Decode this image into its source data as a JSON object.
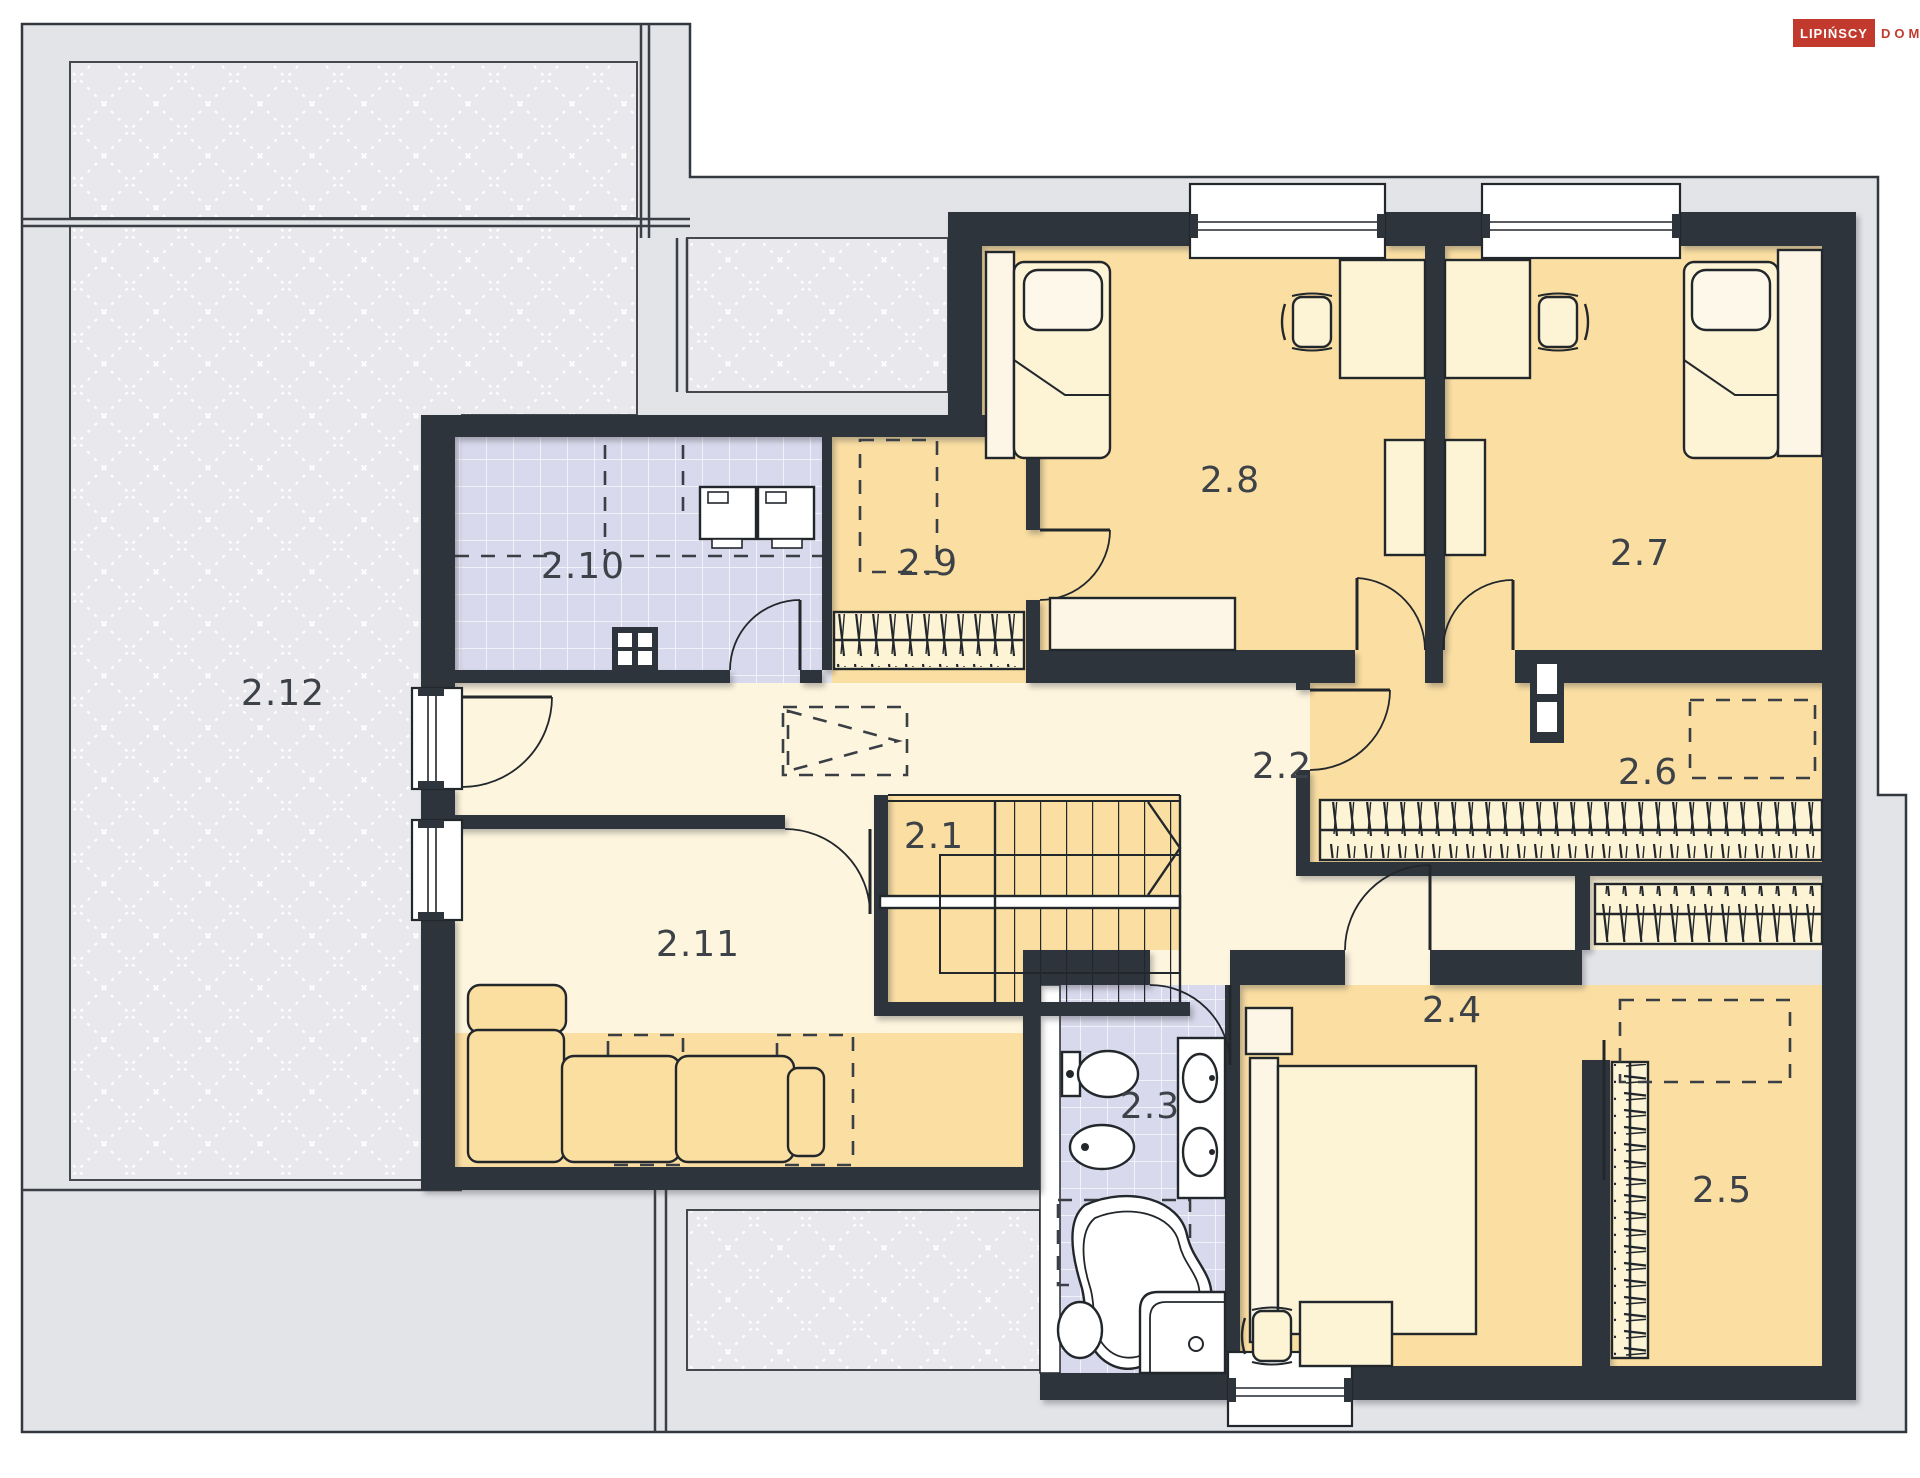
{
  "logo": {
    "primary": "LIPIŃSCY",
    "secondary": "DOMY"
  },
  "rooms": [
    {
      "label": "2.1"
    },
    {
      "label": "2.2"
    },
    {
      "label": "2.3"
    },
    {
      "label": "2.4"
    },
    {
      "label": "2.5"
    },
    {
      "label": "2.6"
    },
    {
      "label": "2.7"
    },
    {
      "label": "2.8"
    },
    {
      "label": "2.9"
    },
    {
      "label": "2.10"
    },
    {
      "label": "2.11"
    },
    {
      "label": "2.12"
    }
  ],
  "colors": {
    "wall": "#2d343c",
    "room_warm": "#fbdfa2",
    "room_light": "#fdf5dd",
    "bathroom_tile": "#d8d9ec",
    "roof_gray": "#e3e4e8",
    "roof_hatch_panel": "#e9e9ed",
    "furniture_cream": "#fdf3d5",
    "logo_red": "#c23a2e",
    "line": "#22272c"
  }
}
